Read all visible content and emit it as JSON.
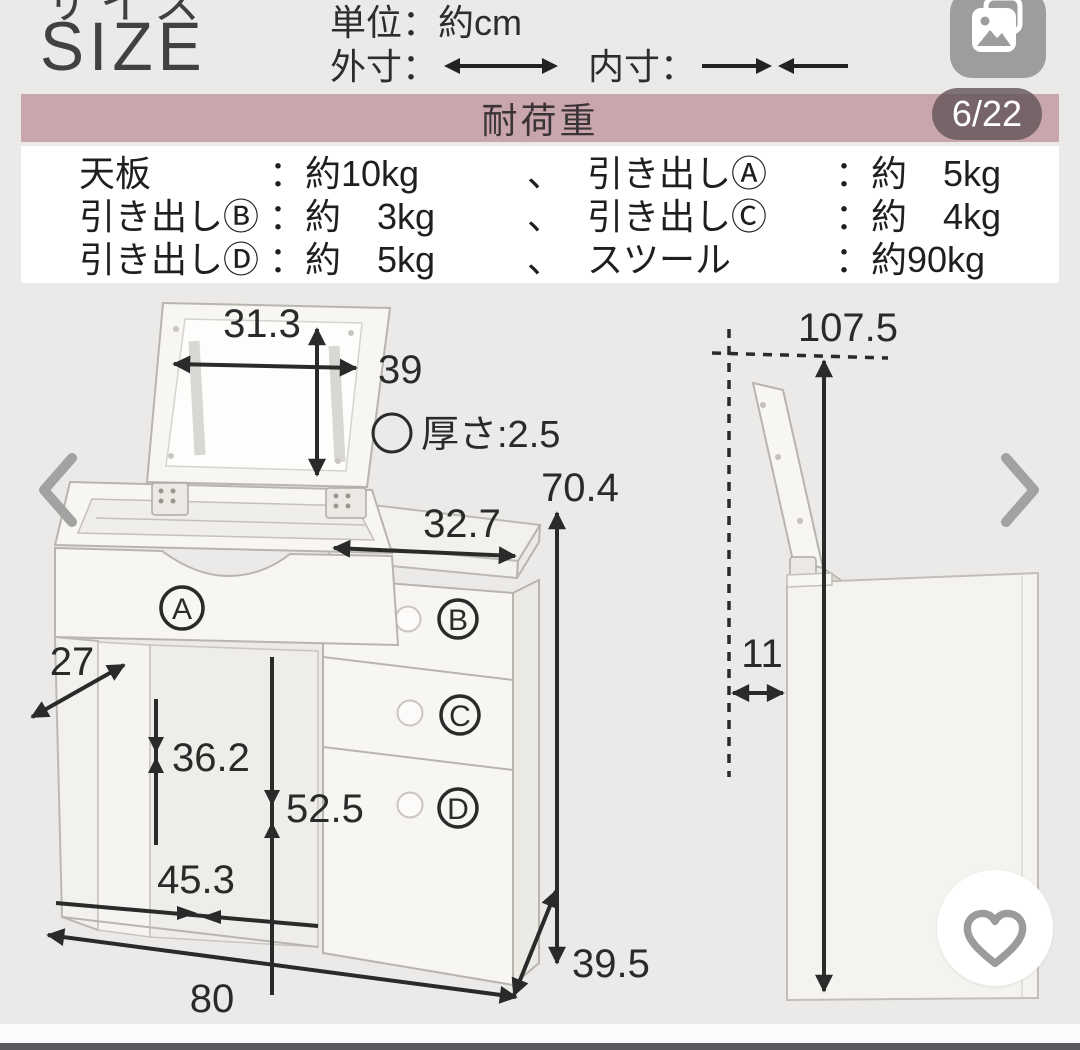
{
  "header": {
    "title_jp": "サイズ",
    "title_en": "SIZE",
    "unit_label": "単位：約cm",
    "outer_dim_label": "外寸：",
    "inner_dim_label": "内寸：",
    "page_indicator": "6/22",
    "photo_icon": "photo-stack-icon"
  },
  "banner": {
    "title": "耐荷重",
    "bg_color": "#c9a5ad",
    "badge_bg_color": "#63545880"
  },
  "load_capacity": {
    "rows": [
      {
        "c1": "天板",
        "c2": "：約10kg",
        "c3": "、",
        "c4": "引き出しⒶ",
        "c5": "：約　5kg"
      },
      {
        "c1": "引き出しⒷ",
        "c2": "：約　3kg",
        "c3": "、",
        "c4": "引き出しⒸ",
        "c5": "：約　4kg"
      },
      {
        "c1": "引き出しⒹ",
        "c2": "：約　5kg",
        "c3": "、",
        "c4": "スツール",
        "c5": "：約90kg"
      }
    ]
  },
  "diagram": {
    "front": {
      "mirror_width": "31.3",
      "mirror_height": "39",
      "thickness_label": "厚さ:2.5",
      "total_height": "70.4",
      "top_depth": "32.7",
      "side_panel_depth": "27",
      "knee_height": "36.2",
      "under_top_height": "52.5",
      "knee_width": "45.3",
      "total_width": "80",
      "total_depth": "39.5",
      "drawer_a": "A",
      "drawer_b": "B",
      "drawer_c": "C",
      "drawer_d": "D"
    },
    "side": {
      "open_lid_height": "107.5",
      "lid_overhang": "11"
    }
  },
  "nav": {
    "prev_icon": "chevron-left-icon",
    "next_icon": "chevron-right-icon",
    "favorite_icon": "heart-icon"
  },
  "colors": {
    "page_bg": "#eceae8",
    "banner_bg": "#c9a5ad",
    "line": "#2a2a2a",
    "nav_gray": "#a2a2a0",
    "bottom_bar": "#5a595d"
  }
}
